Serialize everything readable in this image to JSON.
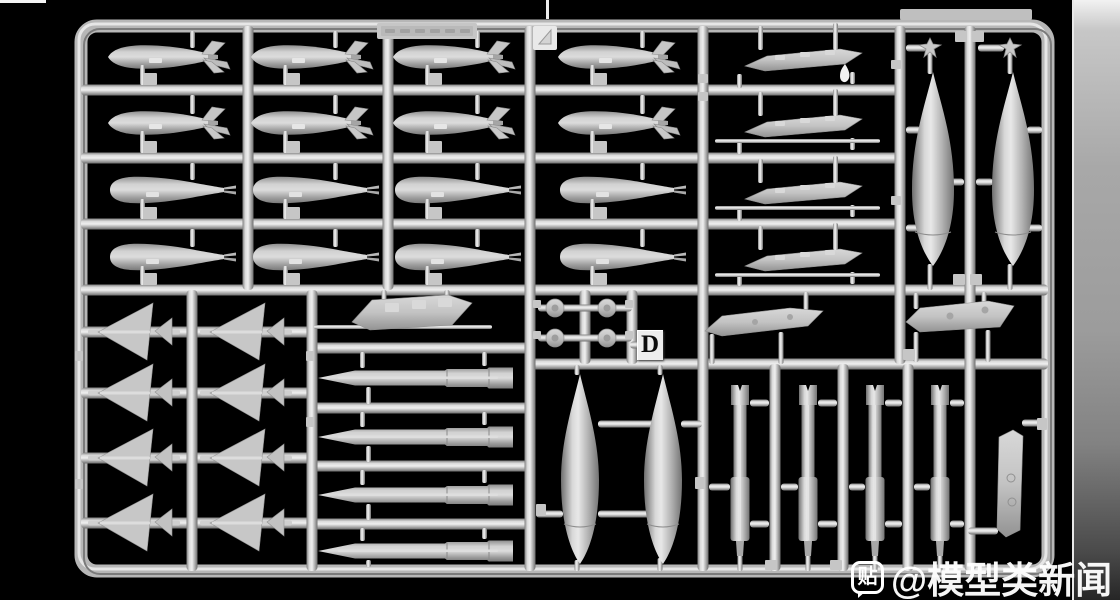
{
  "scene": {
    "background": "#000000",
    "plastic_color": "#c2c2c2",
    "highlight_color": "#ececec",
    "shadow_color": "#6f6f6f"
  },
  "sprue": {
    "letter": "D"
  },
  "watermark": {
    "badge_char": "贴",
    "text": "@模型类新闻"
  },
  "geo": {
    "frame": {
      "x1": 81,
      "y1": 26,
      "x2": 1048,
      "y2": 571,
      "t": 13,
      "r": 16
    },
    "h_runners": [
      [
        81,
        900,
        90
      ],
      [
        81,
        900,
        158
      ],
      [
        81,
        900,
        224
      ],
      [
        81,
        1048,
        290
      ],
      [
        530,
        1048,
        364
      ],
      [
        81,
        312,
        332
      ],
      [
        81,
        312,
        393
      ],
      [
        81,
        312,
        458
      ],
      [
        81,
        312,
        523
      ],
      [
        312,
        530,
        348
      ],
      [
        312,
        530,
        408
      ],
      [
        312,
        530,
        466
      ],
      [
        312,
        530,
        524
      ]
    ],
    "v_runners": [
      [
        248,
        26,
        290
      ],
      [
        388,
        26,
        290
      ],
      [
        530,
        26,
        571
      ],
      [
        703,
        26,
        571
      ],
      [
        900,
        26,
        364
      ],
      [
        970,
        26,
        571
      ],
      [
        192,
        290,
        571
      ],
      [
        312,
        290,
        571
      ],
      [
        585,
        290,
        364
      ],
      [
        632,
        290,
        364
      ],
      [
        775,
        364,
        571
      ],
      [
        843,
        364,
        571
      ],
      [
        908,
        364,
        571
      ]
    ],
    "ties": [
      [
        906,
        921,
        130
      ],
      [
        1027,
        1042,
        130
      ],
      [
        948,
        964,
        182
      ],
      [
        976,
        993,
        182
      ],
      [
        906,
        921,
        228
      ],
      [
        1027,
        1042,
        228
      ],
      [
        906,
        927,
        48
      ],
      [
        978,
        1004,
        48
      ],
      [
        598,
        656,
        424
      ],
      [
        681,
        702,
        424
      ],
      [
        536,
        563,
        514
      ],
      [
        598,
        656,
        514
      ],
      [
        750,
        769,
        403
      ],
      [
        709,
        730,
        487
      ],
      [
        750,
        769,
        524
      ],
      [
        818,
        837,
        403
      ],
      [
        781,
        798,
        487
      ],
      [
        818,
        837,
        524
      ],
      [
        885,
        902,
        403
      ],
      [
        849,
        865,
        487
      ],
      [
        885,
        902,
        524
      ],
      [
        950,
        964,
        403
      ],
      [
        914,
        930,
        487
      ],
      [
        950,
        964,
        524
      ],
      [
        1022,
        1042,
        423
      ],
      [
        968,
        998,
        531
      ],
      [
        538,
        632,
        308
      ],
      [
        538,
        632,
        338
      ],
      [
        630,
        641,
        345
      ]
    ],
    "stubs": [
      [
        577,
        365,
        375
      ],
      [
        660,
        365,
        375
      ],
      [
        577,
        560,
        571
      ],
      [
        660,
        558,
        571
      ],
      [
        930,
        48,
        74
      ],
      [
        1010,
        48,
        74
      ],
      [
        930,
        264,
        290
      ],
      [
        1010,
        264,
        290
      ],
      [
        740,
        554,
        571
      ],
      [
        808,
        554,
        571
      ],
      [
        875,
        554,
        571
      ],
      [
        940,
        554,
        571
      ],
      [
        384,
        290,
        302
      ],
      [
        447,
        290,
        300
      ],
      [
        712,
        334,
        364
      ],
      [
        781,
        332,
        364
      ],
      [
        806,
        292,
        310
      ],
      [
        916,
        293,
        309
      ],
      [
        984,
        292,
        304
      ],
      [
        916,
        332,
        362
      ],
      [
        988,
        330,
        362
      ]
    ],
    "tabs": [
      [
        955,
        31,
        12,
        11
      ],
      [
        972,
        31,
        12,
        11
      ],
      [
        953,
        274,
        12,
        11
      ],
      [
        970,
        274,
        12,
        11
      ],
      [
        533,
        300,
        8,
        8
      ],
      [
        625,
        300,
        8,
        8
      ],
      [
        533,
        331,
        8,
        8
      ],
      [
        625,
        331,
        8,
        8
      ],
      [
        695,
        477,
        10,
        12
      ],
      [
        536,
        504,
        10,
        12
      ],
      [
        903,
        349,
        12,
        11
      ],
      [
        1037,
        418,
        10,
        12
      ],
      [
        765,
        560,
        12,
        10
      ],
      [
        830,
        560,
        12,
        10
      ],
      [
        75,
        351,
        8,
        10
      ],
      [
        75,
        479,
        8,
        10
      ],
      [
        306,
        351,
        8,
        10
      ],
      [
        306,
        417,
        8,
        10
      ],
      [
        698,
        74,
        10,
        9
      ],
      [
        698,
        92,
        10,
        9
      ],
      [
        891,
        196,
        10,
        9
      ],
      [
        891,
        60,
        10,
        9
      ]
    ],
    "bomb_cols": [
      170,
      313,
      455,
      620
    ],
    "finned_rows": [
      {
        "y": 57,
        "top": 26,
        "bot": 90
      },
      {
        "y": 123,
        "top": 90,
        "bot": 158
      }
    ],
    "slick_rows": [
      {
        "y": 190,
        "top": 158,
        "bot": 224
      },
      {
        "y": 257,
        "top": 224,
        "bot": 290
      }
    ],
    "missiles": {
      "x1": 318,
      "rows": [
        {
          "y": 378,
          "top": 348,
          "bot": 408
        },
        {
          "y": 437,
          "top": 408,
          "bot": 466
        },
        {
          "y": 495,
          "top": 466,
          "bot": 524
        },
        {
          "y": 551,
          "top": 524,
          "bot": 571
        }
      ]
    },
    "fin_rows": [
      332,
      393,
      458,
      523
    ],
    "fin_axs": [
      98,
      210
    ],
    "pylons": {
      "ys": [
        58,
        124,
        191,
        258
      ],
      "x1": 745
    },
    "rack": {
      "cx": 412,
      "cy": 312
    },
    "discs": [
      [
        555,
        308
      ],
      [
        607,
        308
      ],
      [
        555,
        338
      ],
      [
        607,
        338
      ]
    ],
    "tanks_top": {
      "cx": [
        933,
        1013
      ],
      "y1": 72,
      "y2": 266,
      "hw": 21
    },
    "tanks_bottom": {
      "cx": [
        580,
        663
      ],
      "y1": 374,
      "y2": 564,
      "hw": 19
    },
    "rails": [
      740,
      808,
      875,
      940
    ],
    "star_caps": [
      930,
      1010
    ],
    "panel_a": [
      [
        705,
        331
      ],
      [
        722,
        316
      ],
      [
        790,
        308
      ],
      [
        823,
        311
      ],
      [
        808,
        326
      ],
      [
        722,
        336
      ]
    ],
    "panel_b": [
      [
        906,
        322
      ],
      [
        920,
        308
      ],
      [
        988,
        301
      ],
      [
        1014,
        306
      ],
      [
        1000,
        327
      ],
      [
        920,
        332
      ]
    ],
    "fin_panel": [
      [
        999,
        437
      ],
      [
        1013,
        430
      ],
      [
        1023,
        436
      ],
      [
        1020,
        530
      ],
      [
        1006,
        537
      ],
      [
        997,
        529
      ]
    ],
    "nameplate": [
      377,
      23,
      100,
      16
    ],
    "top_plate": [
      900,
      9,
      132,
      11
    ],
    "corner_tab": [
      533,
      26,
      24,
      24
    ],
    "drip": [
      845,
      64
    ]
  }
}
